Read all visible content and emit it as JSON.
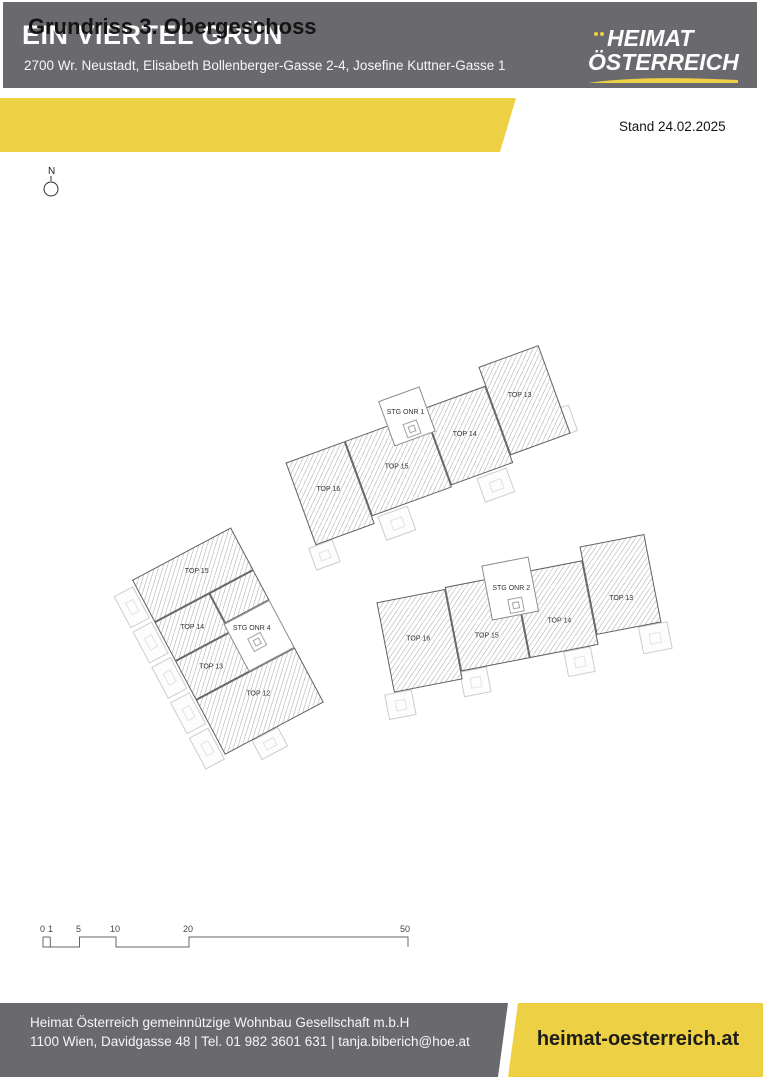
{
  "header": {
    "title": "EIN VIERTEL GRÜN",
    "address": "2700 Wr. Neustadt, Elisabeth Bollenberger-Gasse 2-4, Josefine Kuttner-Gasse 1",
    "logo": {
      "line1": "HEIMAT",
      "line2": "ÖSTERREICH"
    }
  },
  "banner": {
    "title": "Grundriss 3. Obergeschoss",
    "stand": "Stand 24.02.2025"
  },
  "compass": {
    "label": "N"
  },
  "plan": {
    "buildings": [
      {
        "units": [
          {
            "label": "TOP 16"
          },
          {
            "label": "TOP 15"
          },
          {
            "label": "TOP 14"
          },
          {
            "label": "TOP 13"
          },
          {
            "label": "STG ONR 1"
          }
        ]
      },
      {
        "units": [
          {
            "label": "TOP 15"
          },
          {
            "label": "TOP 14"
          },
          {
            "label": "TOP 13"
          },
          {
            "label": "TOP 12"
          },
          {
            "label": "STG ONR 4"
          }
        ]
      },
      {
        "units": [
          {
            "label": "TOP 16"
          },
          {
            "label": "TOP 15"
          },
          {
            "label": "TOP 14"
          },
          {
            "label": "TOP 13"
          },
          {
            "label": "STG ONR 2"
          }
        ]
      }
    ]
  },
  "scalebar": {
    "ticks": [
      "0",
      "1",
      "5",
      "10",
      "20",
      "50"
    ]
  },
  "footer": {
    "company": "Heimat Österreich gemeinnützige Wohnbau Gesellschaft m.b.H",
    "contact": "1100 Wien, Davidgasse 48 | Tel. 01 982 3601 631 | tanja.biberich@hoe.at",
    "website": "heimat-oesterreich.at"
  },
  "colors": {
    "brand_gray": "#6a696e",
    "brand_yellow": "#edd043",
    "text_dark": "#1d1d1b"
  }
}
